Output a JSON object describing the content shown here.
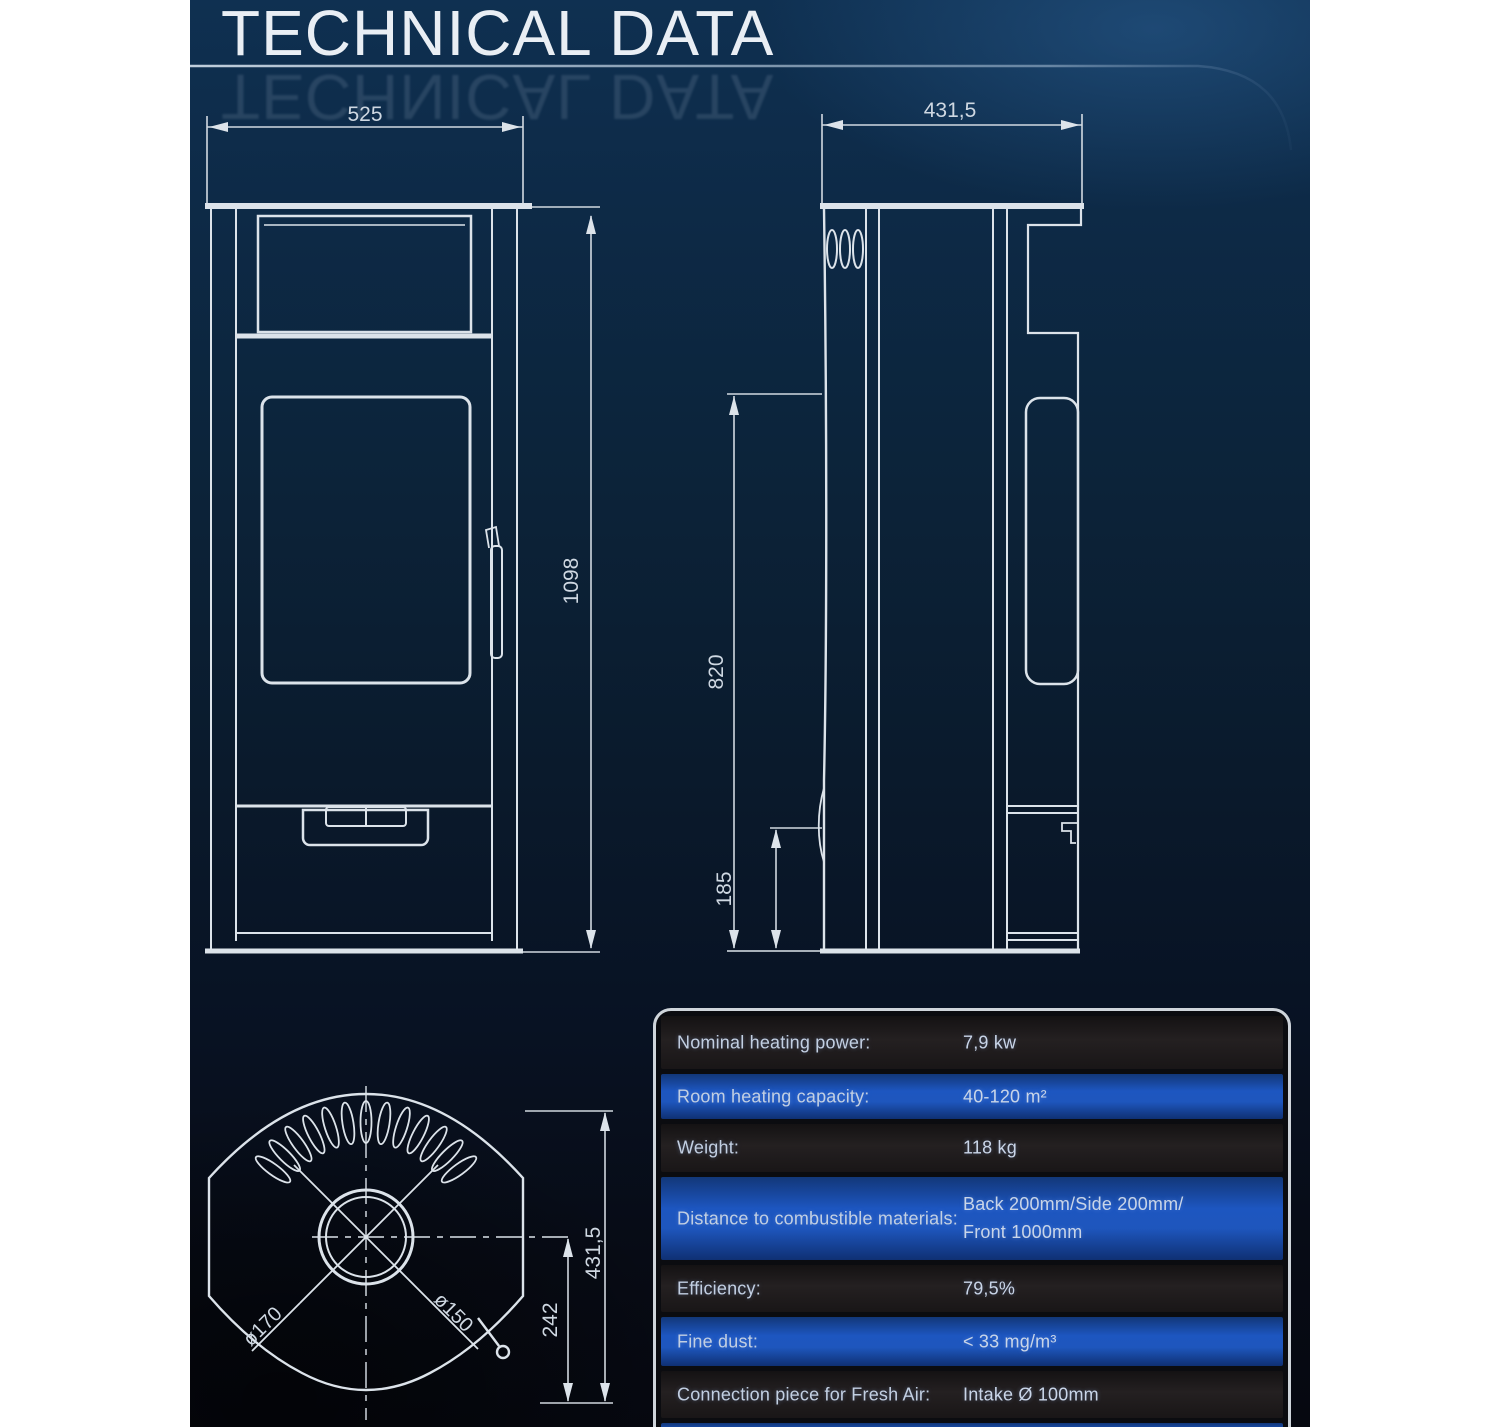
{
  "page": {
    "title": "TECHNICAL DATA"
  },
  "colors": {
    "margin": "#ffffff",
    "background_top": "#0f3051",
    "background_bottom": "#060810",
    "drawing_line": "#dce3ea",
    "row_dark": "#201d1e",
    "row_blue": "#1d56c0",
    "table_border": "#cfd5db",
    "text": "#c2cfe2"
  },
  "drawings": {
    "front_view": {
      "width": "525",
      "height": "1098"
    },
    "side_view": {
      "depth": "431,5",
      "upper_edge_height": "820",
      "flue_height": "185"
    },
    "top_view": {
      "depth": "431,5",
      "flue_to_front": "242",
      "outer_diameter": "ø170",
      "inner_diameter": "ø150"
    }
  },
  "table": {
    "rows": [
      {
        "label": "Nominal heating power:",
        "value": "7,9 kw"
      },
      {
        "label": "Room heating capacity:",
        "value": "40-120 m²"
      },
      {
        "label": "Weight:",
        "value": "118 kg"
      },
      {
        "label": "Distance to combustible materials:",
        "value": "Back 200mm/Side 200mm/",
        "value2": "Front 1000mm"
      },
      {
        "label": "Efficiency:",
        "value": "79,5%"
      },
      {
        "label": "Fine dust:",
        "value": "< 33 mg/m³"
      },
      {
        "label": "Connection piece for Fresh Air:",
        "value": "Intake Ø 100mm"
      }
    ]
  }
}
